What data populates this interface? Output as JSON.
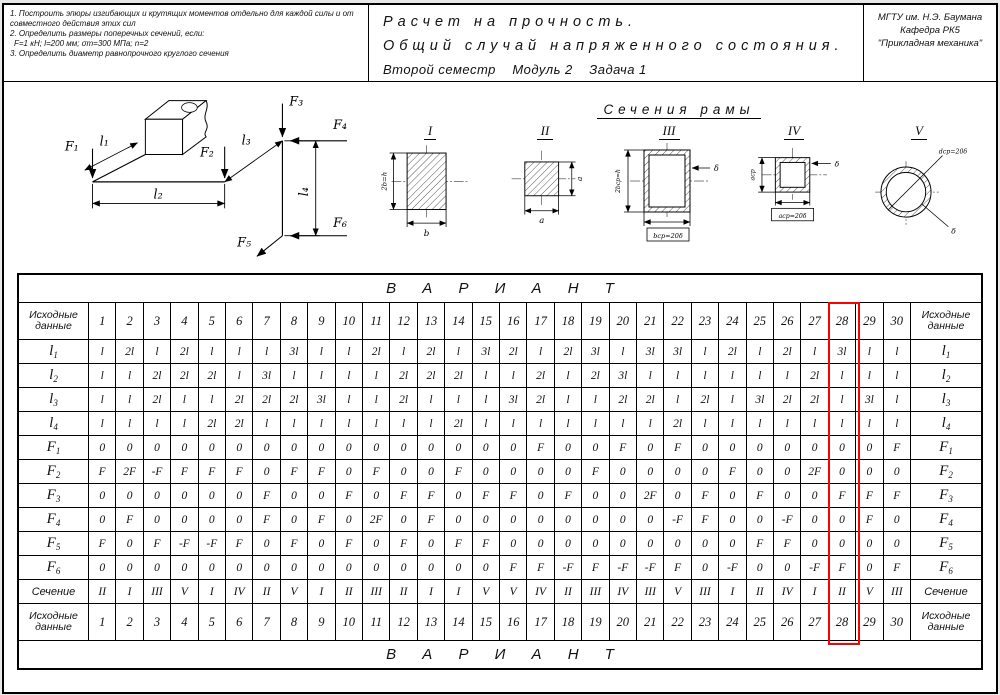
{
  "header": {
    "tasks": [
      "1. Построить эпюры изгибающих и крутящих моментов отдельно для каждой силы и от совместного действия этих сил",
      "2. Определить размеры поперечных сечений, если:",
      "F=1 кН;  l=200 мм;  σт=300 МПа;  n=2",
      "3. Определить диаметр равнопрочного круглого сечения"
    ],
    "title_lines": [
      "Расчет на прочность.",
      "Общий случай напряженного состояния.",
      "Второй семестр    Модуль 2    Задача 1"
    ],
    "org_lines": [
      "МГТУ им. Н.Э. Баумана",
      "Кафедра РК5",
      "\"Прикладная механика\""
    ]
  },
  "drawing": {
    "frame": {
      "f1": "F₁",
      "f2": "F₂",
      "f3": "F₃",
      "f4": "F₄",
      "f5": "F₅",
      "f6": "F₆",
      "l1": "l₁",
      "l2": "l₂",
      "l3": "l₃",
      "l4": "l₄"
    },
    "sections": {
      "title": "Сечения рамы",
      "items": [
        {
          "numeral": "I",
          "dim_left": "2b=h",
          "dim_bottom": "b"
        },
        {
          "numeral": "II",
          "dim_right": "a",
          "dim_bottom": "a"
        },
        {
          "numeral": "III",
          "dim_left": "2bср=h",
          "wall": "δ",
          "dim_bottom": "bср=20δ"
        },
        {
          "numeral": "IV",
          "dim_left": "aср",
          "wall": "δ",
          "dim_bottom": "aср=20δ"
        },
        {
          "numeral": "V",
          "dim_diag": "dср=20δ",
          "wall": "δ"
        }
      ]
    }
  },
  "table": {
    "variant_title": "В А Р И А Н Т",
    "corner_label": "Исходные данные",
    "columns": [
      "1",
      "2",
      "3",
      "4",
      "5",
      "6",
      "7",
      "8",
      "9",
      "10",
      "11",
      "12",
      "13",
      "14",
      "15",
      "16",
      "17",
      "18",
      "19",
      "20",
      "21",
      "22",
      "23",
      "24",
      "25",
      "26",
      "27",
      "28",
      "29",
      "30"
    ],
    "rows": [
      {
        "label": "l",
        "sub": "1",
        "values": [
          "l",
          "2l",
          "l",
          "2l",
          "l",
          "l",
          "l",
          "3l",
          "l",
          "l",
          "2l",
          "l",
          "2l",
          "l",
          "3l",
          "2l",
          "l",
          "2l",
          "3l",
          "l",
          "3l",
          "3l",
          "l",
          "2l",
          "l",
          "2l",
          "l",
          "3l",
          "l",
          "l"
        ]
      },
      {
        "label": "l",
        "sub": "2",
        "values": [
          "l",
          "l",
          "2l",
          "2l",
          "2l",
          "l",
          "3l",
          "l",
          "l",
          "l",
          "l",
          "2l",
          "2l",
          "2l",
          "l",
          "l",
          "2l",
          "l",
          "2l",
          "3l",
          "l",
          "l",
          "l",
          "l",
          "l",
          "l",
          "2l",
          "l",
          "l",
          "l"
        ]
      },
      {
        "label": "l",
        "sub": "3",
        "values": [
          "l",
          "l",
          "2l",
          "l",
          "l",
          "2l",
          "2l",
          "2l",
          "3l",
          "l",
          "l",
          "2l",
          "l",
          "l",
          "l",
          "3l",
          "2l",
          "l",
          "l",
          "2l",
          "2l",
          "l",
          "2l",
          "l",
          "3l",
          "2l",
          "2l",
          "l",
          "3l",
          "l"
        ]
      },
      {
        "label": "l",
        "sub": "4",
        "values": [
          "l",
          "l",
          "l",
          "l",
          "2l",
          "2l",
          "l",
          "l",
          "l",
          "l",
          "l",
          "l",
          "l",
          "2l",
          "l",
          "l",
          "l",
          "l",
          "l",
          "l",
          "l",
          "2l",
          "l",
          "l",
          "l",
          "l",
          "l",
          "l",
          "l",
          "l"
        ]
      },
      {
        "label": "F",
        "sub": "1",
        "values": [
          "0",
          "0",
          "0",
          "0",
          "0",
          "0",
          "0",
          "0",
          "0",
          "0",
          "0",
          "0",
          "0",
          "0",
          "0",
          "0",
          "F",
          "0",
          "0",
          "F",
          "0",
          "F",
          "0",
          "0",
          "0",
          "0",
          "0",
          "0",
          "0",
          "F"
        ]
      },
      {
        "label": "F",
        "sub": "2",
        "values": [
          "F",
          "2F",
          "-F",
          "F",
          "F",
          "F",
          "0",
          "F",
          "F",
          "0",
          "F",
          "0",
          "0",
          "F",
          "0",
          "0",
          "0",
          "0",
          "F",
          "0",
          "0",
          "0",
          "0",
          "F",
          "0",
          "0",
          "2F",
          "0",
          "0",
          "0"
        ]
      },
      {
        "label": "F",
        "sub": "3",
        "values": [
          "0",
          "0",
          "0",
          "0",
          "0",
          "0",
          "F",
          "0",
          "0",
          "F",
          "0",
          "F",
          "F",
          "0",
          "F",
          "F",
          "0",
          "F",
          "0",
          "0",
          "2F",
          "0",
          "F",
          "0",
          "F",
          "0",
          "0",
          "F",
          "F",
          "F"
        ]
      },
      {
        "label": "F",
        "sub": "4",
        "values": [
          "0",
          "F",
          "0",
          "0",
          "0",
          "0",
          "F",
          "0",
          "F",
          "0",
          "2F",
          "0",
          "F",
          "0",
          "0",
          "0",
          "0",
          "0",
          "0",
          "0",
          "0",
          "-F",
          "F",
          "0",
          "0",
          "-F",
          "0",
          "0",
          "F",
          "0"
        ]
      },
      {
        "label": "F",
        "sub": "5",
        "values": [
          "F",
          "0",
          "F",
          "-F",
          "-F",
          "F",
          "0",
          "F",
          "0",
          "F",
          "0",
          "F",
          "0",
          "F",
          "F",
          "0",
          "0",
          "0",
          "0",
          "0",
          "0",
          "0",
          "0",
          "0",
          "F",
          "F",
          "0",
          "0",
          "0",
          "0"
        ]
      },
      {
        "label": "F",
        "sub": "6",
        "values": [
          "0",
          "0",
          "0",
          "0",
          "0",
          "0",
          "0",
          "0",
          "0",
          "0",
          "0",
          "0",
          "0",
          "0",
          "0",
          "F",
          "F",
          "-F",
          "F",
          "-F",
          "-F",
          "F",
          "0",
          "-F",
          "0",
          "0",
          "-F",
          "F",
          "0",
          "F"
        ]
      },
      {
        "label": "Сечение",
        "values": [
          "II",
          "I",
          "III",
          "V",
          "I",
          "IV",
          "II",
          "V",
          "I",
          "II",
          "III",
          "II",
          "I",
          "I",
          "V",
          "V",
          "IV",
          "II",
          "III",
          "IV",
          "III",
          "V",
          "III",
          "I",
          "II",
          "IV",
          "I",
          "II",
          "V",
          "III"
        ]
      }
    ],
    "highlight_column": "28",
    "highlight_color": "#ff0000"
  }
}
